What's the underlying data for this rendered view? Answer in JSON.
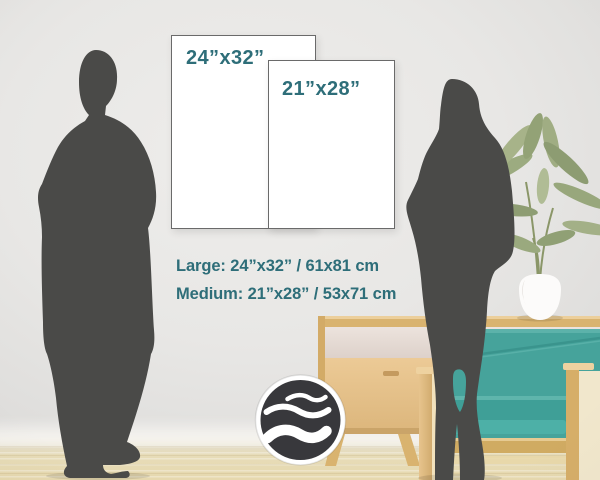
{
  "posters": {
    "large": {
      "label": "24”x32”"
    },
    "medium": {
      "label": "21”x28”"
    }
  },
  "legend": {
    "large": "Large: 24”x32” / 61x81 cm",
    "medium": "Medium: 21”x28” / 53x71 cm"
  },
  "brand": {
    "logo_icon": "wave-logo-icon"
  },
  "colors": {
    "accent_teal_text": "#2e6e79",
    "chair_teal": "#46a39b",
    "seat_teal": "#3f9f97",
    "silhouette_gray": "#4a4a48",
    "wood_light": "#e4c28d",
    "poster_border": "#6a6a6a",
    "logo_dark": "#38383c",
    "wall_gray": "#e8e7e5",
    "floor_beige": "#e6d9b2",
    "plant_green": "#9aa97e"
  }
}
